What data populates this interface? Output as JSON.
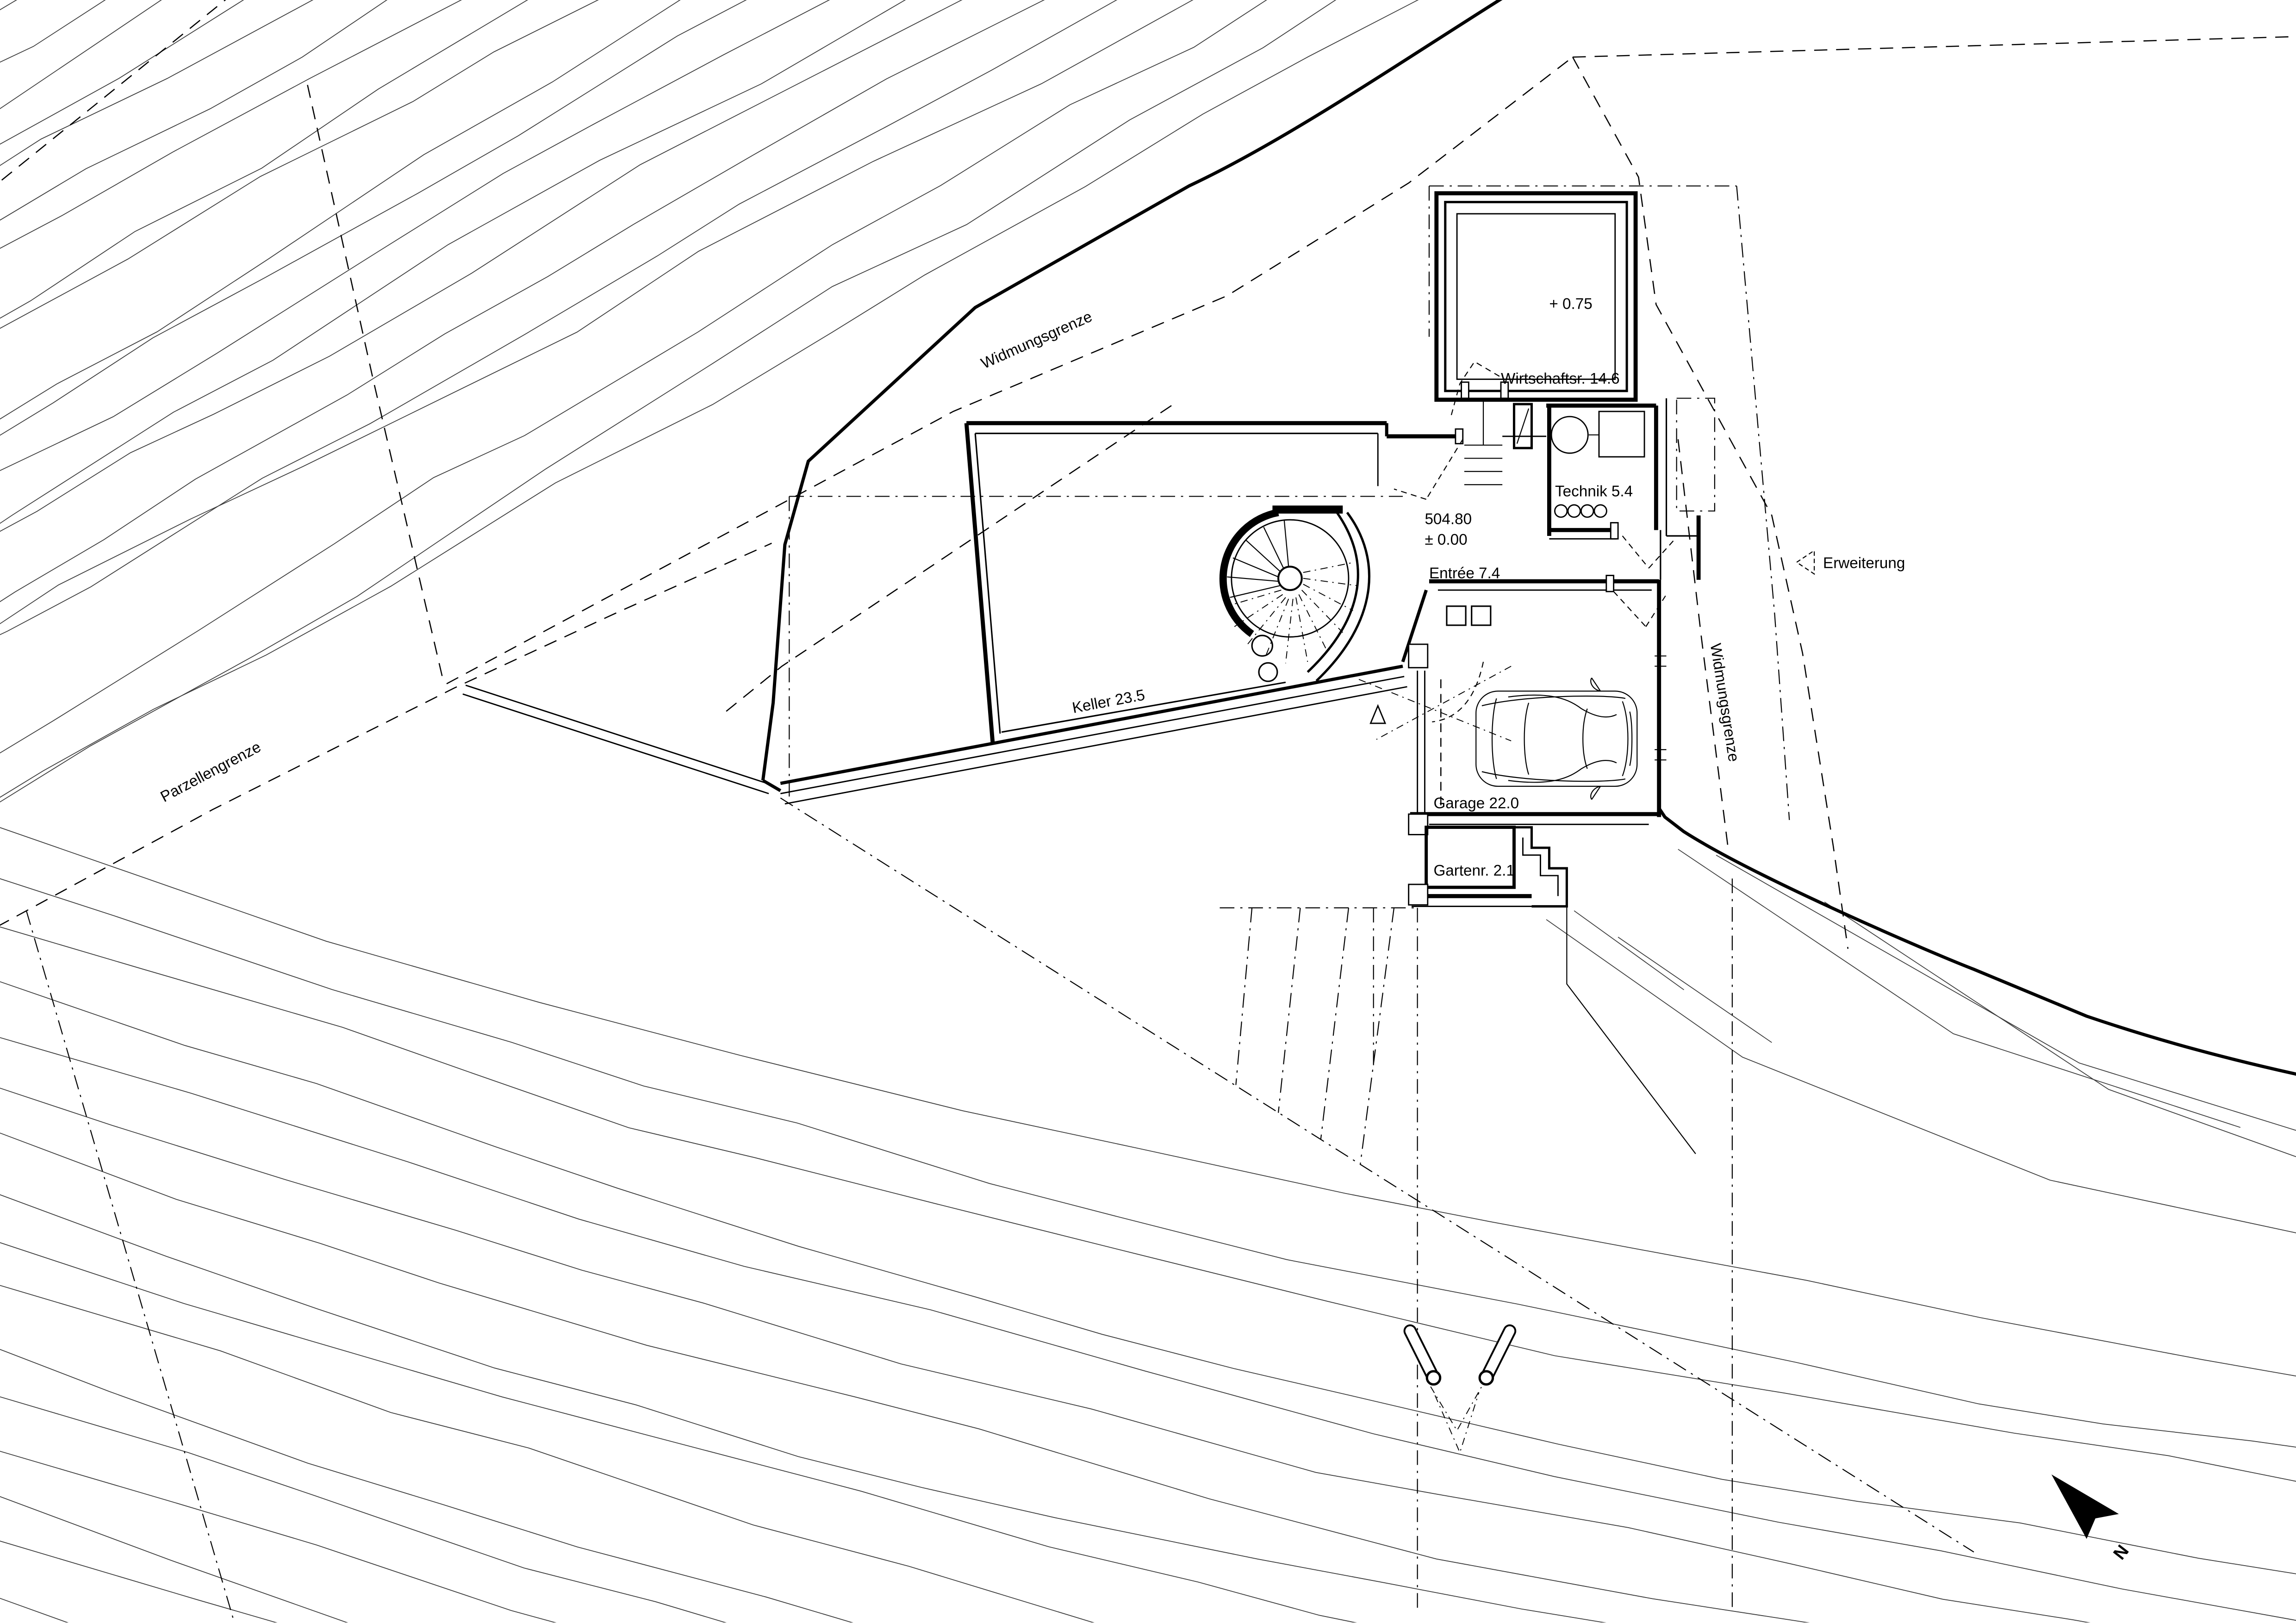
{
  "plan": {
    "labels": {
      "widmungsgrenze_top": "Widmungsgrenze",
      "widmungsgrenze_right": "Widmungsgrenze",
      "parzellengrenze": "Parzellengrenze",
      "erweiterung": "Erweiterung",
      "keller": "Keller 23.5",
      "wirtschaftsraum": "Wirtschaftsr. 14.6",
      "technik": "Technik 5.4",
      "entree": "Entrée 7.4",
      "garage": "Garage 22.0",
      "gartenraum": "Gartenr. 2.1",
      "level_upper": "+ 0.75",
      "elevation_absolute": "504.80",
      "elevation_relative": "± 0.00",
      "north": "N"
    }
  }
}
